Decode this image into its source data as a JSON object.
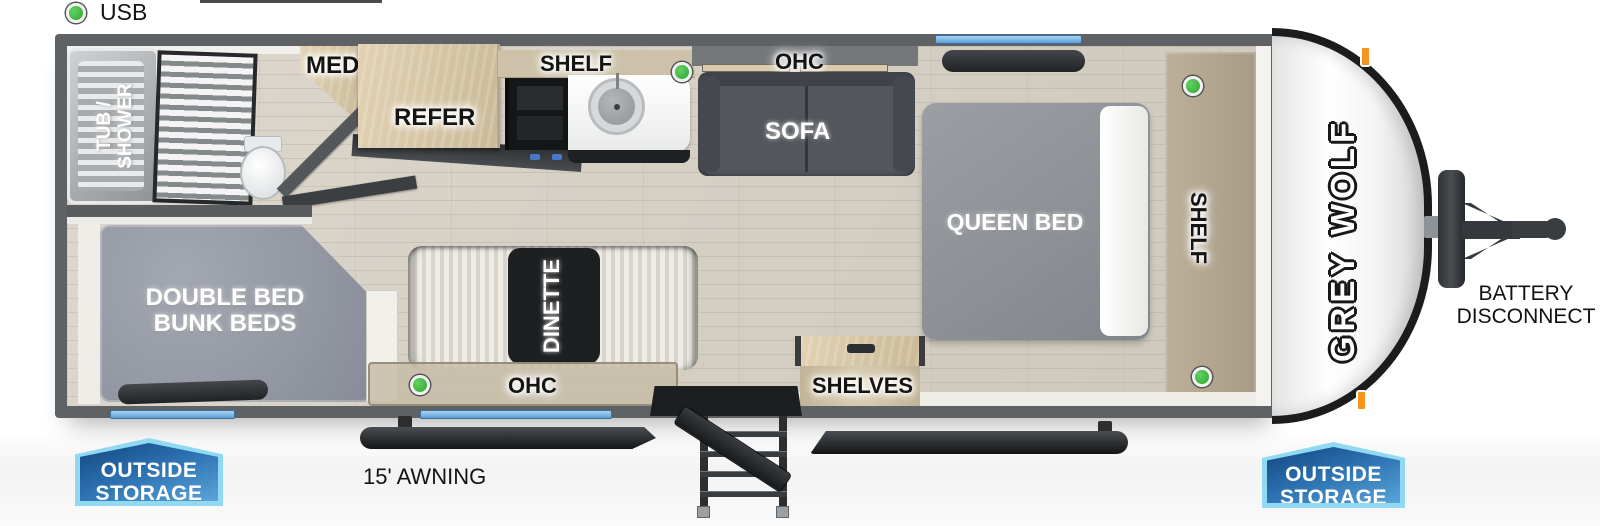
{
  "legend": {
    "usb": "USB"
  },
  "labels": {
    "tub_shower_1": "TUB /",
    "tub_shower_2": "SHOWER",
    "med": "MED",
    "refer": "REFER",
    "kitchen_shelf": "SHELF",
    "ohc_top": "OHC",
    "sofa": "SOFA",
    "queen_bed": "QUEEN BED",
    "bedroom_shelf": "SHELF",
    "bunk_1": "DOUBLE BED",
    "bunk_2": "BUNK BEDS",
    "dinette": "DINETTE",
    "ohc_bottom": "OHC",
    "shelves": "SHELVES",
    "awning": "15' AWNING",
    "battery_1": "BATTERY",
    "battery_2": "DISCONNECT",
    "outside_storage_1": "OUTSIDE",
    "outside_storage_2": "STORAGE",
    "brand": "GREY WOLF"
  },
  "colors": {
    "wall_gray": "#5f6264",
    "window_blue": "#6fb0e4",
    "badge_blue": "#2a6eae",
    "badge_border": "#8fd9f2",
    "usb_green": "#3bbf3b",
    "wood_tan": "#d6c5a4",
    "marker_orange": "#f7941d"
  }
}
